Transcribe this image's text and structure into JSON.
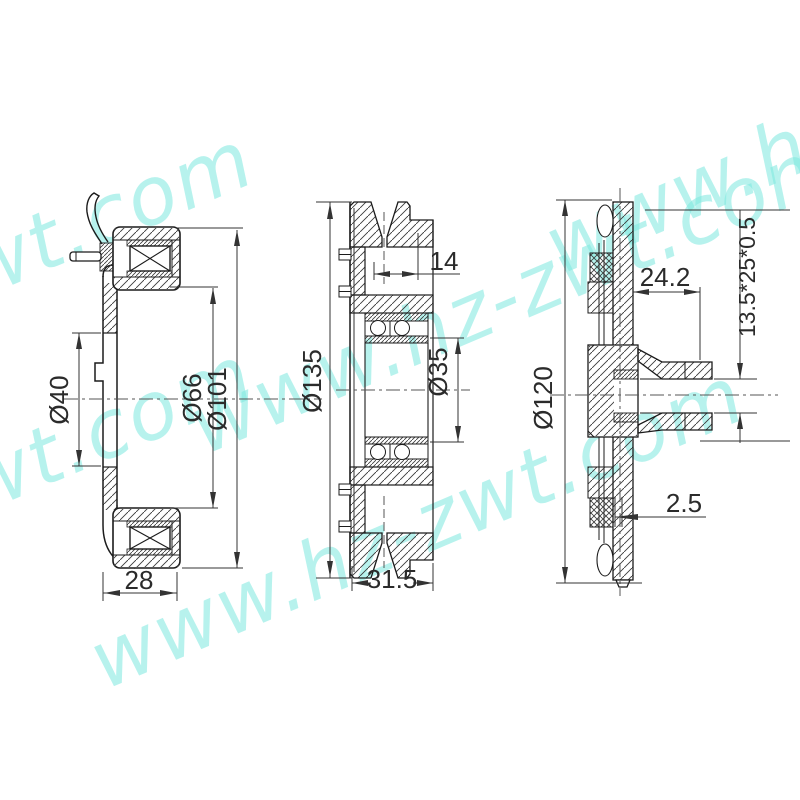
{
  "watermark": {
    "text": "www.hz-zwt.com",
    "color": "#7ee9e0"
  },
  "views": {
    "left": {
      "dims": {
        "bore_diameter": "Ø40",
        "inner_diameter": "Ø66",
        "outer_diameter": "Ø101",
        "width": "28"
      }
    },
    "middle": {
      "dims": {
        "outer_diameter": "Ø135",
        "bearing_bore": "Ø35",
        "groove_offset": "14",
        "width": "31.5"
      }
    },
    "right": {
      "dims": {
        "outer_diameter": "Ø120",
        "hub_length": "24.2",
        "spline_spec": "13.5*25*0.5",
        "plate_thickness": "2.5"
      }
    }
  },
  "colors": {
    "line": "#1b1b1b",
    "dimension": "#2b2b2b",
    "background": "#ffffff",
    "watermark": "#7ee9e0"
  }
}
